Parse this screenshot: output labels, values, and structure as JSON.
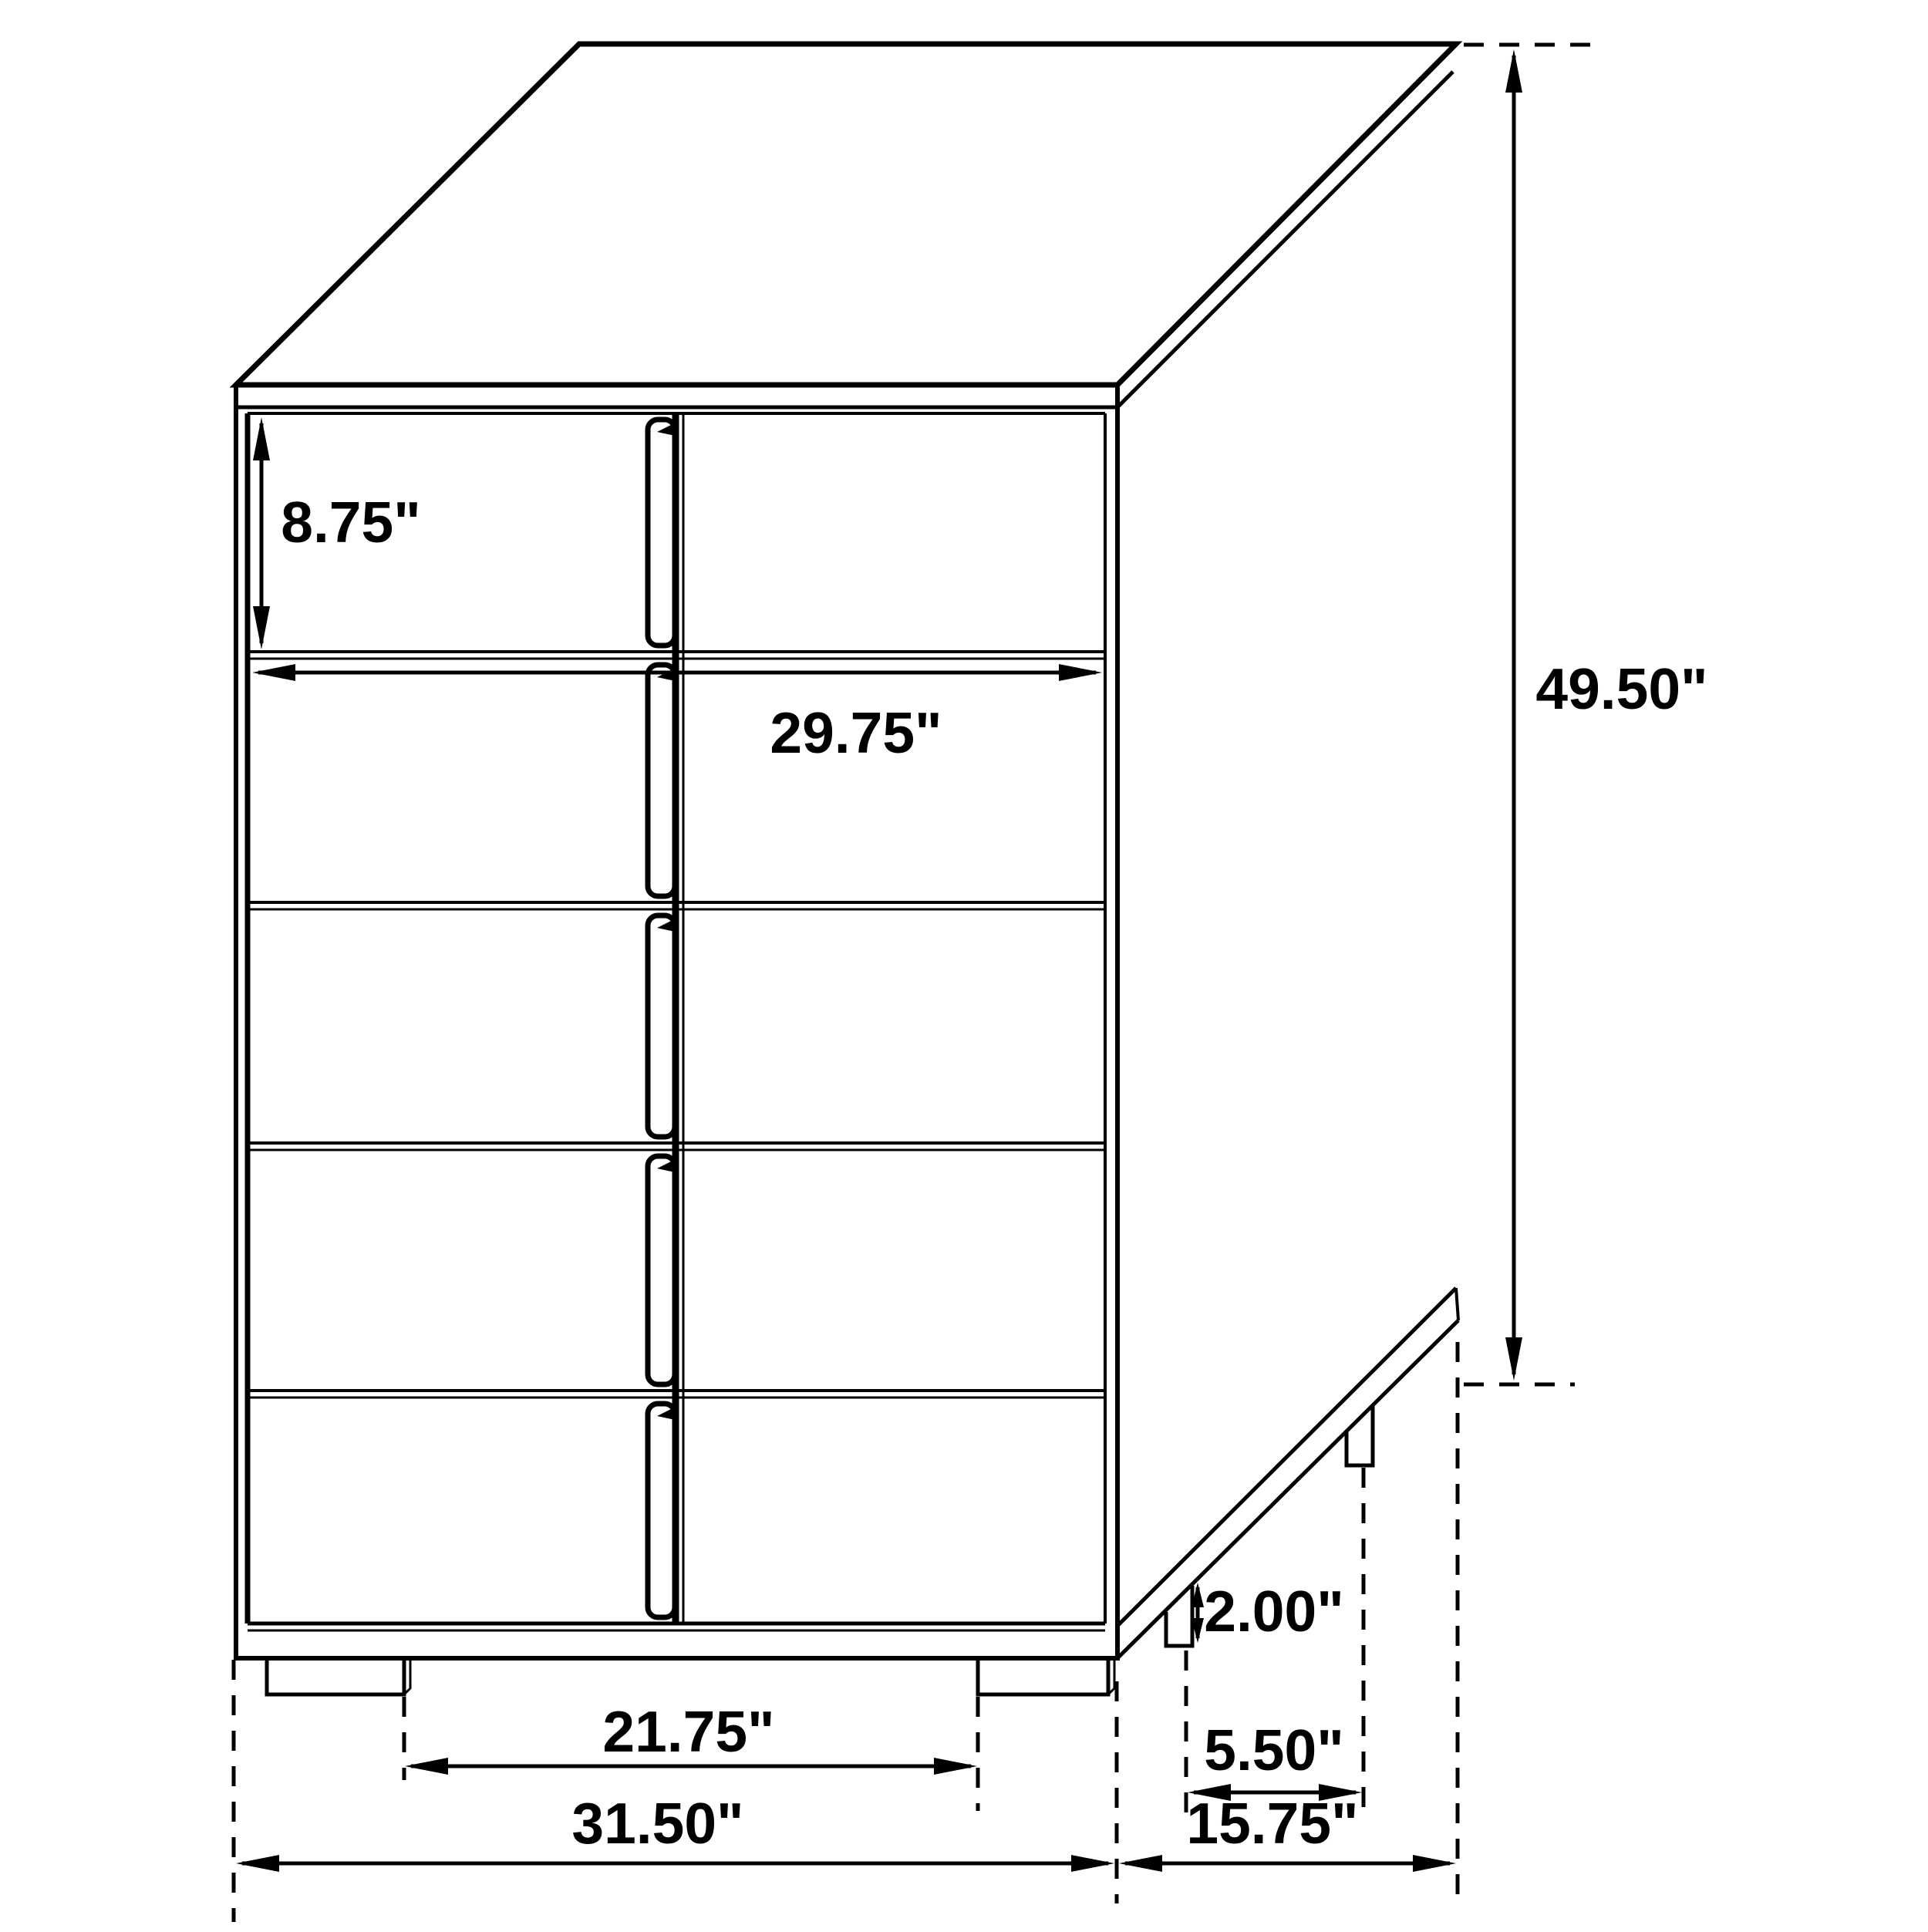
{
  "drawing": {
    "type": "furniture-dimension-diagram",
    "subject": "five-drawer chest, three-quarter line view",
    "unit": "inches",
    "colors": {
      "line": "#000000",
      "background": "#ffffff",
      "text": "#000000"
    },
    "dimensions": {
      "drawer_height": {
        "label": "8.75\"",
        "orientation": "vertical",
        "measures": "top drawer front height"
      },
      "drawer_width": {
        "label": "29.75\"",
        "orientation": "horizontal",
        "measures": "drawer front width"
      },
      "overall_height": {
        "label": "49.50\"",
        "orientation": "vertical",
        "measures": "overall height"
      },
      "leg_height": {
        "label": "2.00\"",
        "orientation": "vertical",
        "measures": "leg height"
      },
      "leg_depth_inset": {
        "label": "5.50\"",
        "orientation": "horizontal",
        "measures": "side leg spacing"
      },
      "front_leg_spacing": {
        "label": "21.75\"",
        "orientation": "horizontal",
        "measures": "distance between front legs"
      },
      "overall_width": {
        "label": "31.50\"",
        "orientation": "horizontal",
        "measures": "overall width"
      },
      "overall_depth": {
        "label": "15.75\"",
        "orientation": "horizontal",
        "measures": "overall depth"
      }
    },
    "drawer_count": 5
  }
}
